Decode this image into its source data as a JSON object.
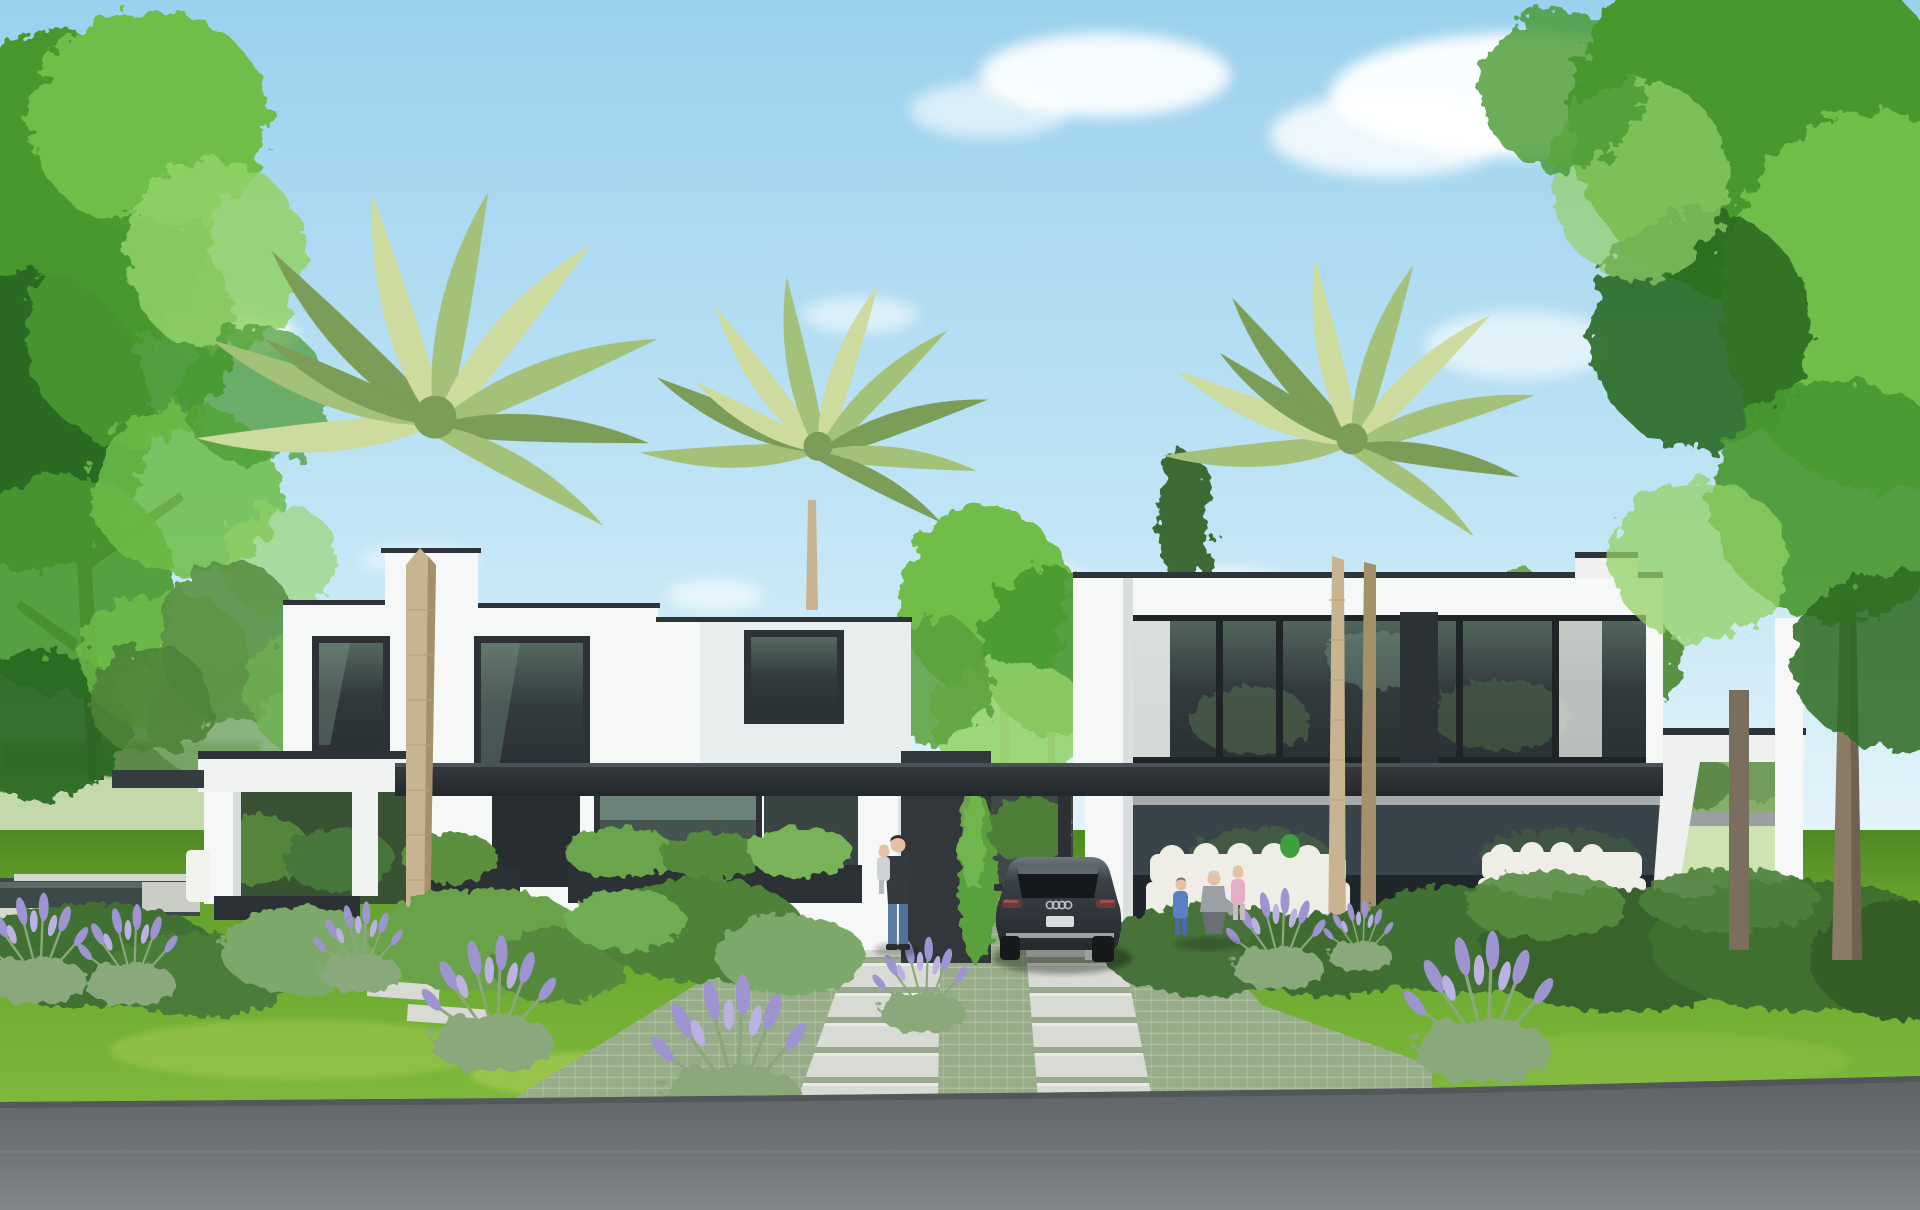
{
  "scene": {
    "type": "architectural-exterior-rendering",
    "description": "Daytime photorealistic render of two modern white flat-roof villas with dark window bands, connected by a dark carport canopy. Front garden with boxwood hedges, sage bushes and lavender, three palm trees, large deciduous trees at both edges, reflecting pond at left, green-paver driveway with light slab walkways, dark SUV parked under the canopy, a man carrying a child on the walkway, two children with an adult by the right hedge, white outdoor lounge furniture on both terraces, asphalt road in the foreground",
    "time_of_day": "day",
    "weather": "sunny, scattered soft clouds"
  },
  "objects": {
    "houses": 2,
    "palm_trees": 3,
    "deciduous_tree_groups": 2,
    "car": {
      "type": "suv",
      "badge": "audi-rings",
      "view": "rear",
      "color_name": "dark-gray"
    },
    "people": [
      {
        "who": "man-carrying-child",
        "clothing": "dark jacket, blue jeans"
      },
      {
        "who": "toddler",
        "clothing": "blue overalls"
      },
      {
        "who": "crouching-adult",
        "clothing": "gray"
      },
      {
        "who": "child",
        "clothing": "pink"
      }
    ],
    "pond": 1,
    "lavender_clusters": 9,
    "outdoor_sofa_groups": 3
  },
  "palette": {
    "sky-top": "#9bd1ee",
    "sky-mid": "#bfe4f5",
    "sky-horizon": "#e9f5fa",
    "cloud": "#ffffff",
    "tree-dark": "#2a6a22",
    "tree-mid": "#49982f",
    "tree-light": "#6fbd49",
    "tree-lighter": "#92d266",
    "palm-light": "#cddc9e",
    "palm-mid": "#a3c178",
    "palm-dark": "#7c9d57",
    "palm-trunk": "#c8b491",
    "palm-trunk-shadow": "#a5906c",
    "house-white": "#f5f8f7",
    "house-shade": "#e3e8e9",
    "coping": "#2e3438",
    "fascia": "#353c40",
    "fascia-dark": "#23282b",
    "glass": "#323a3e",
    "glass-frame": "#2c3236",
    "glass-reflect": "#8aa79b",
    "curtain": "#e9ece9",
    "door": "#282e32",
    "meadow": "#c3d9ab",
    "distant-hedge": "#5d8a49",
    "lawn": "#74b135",
    "lawn-dark": "#4e8822",
    "lawn-light": "#a6cb52",
    "hedge": "#3f7031",
    "hedge-light": "#69a24a",
    "bush-sage": "#7ba86a",
    "lavender": "#9d94d0",
    "lavender-light": "#bcb2e2",
    "lavender-leaf": "#8aa87c",
    "paver": "#9db191",
    "paver-line": "#c3cfb7",
    "slab": "#d8dbd3",
    "slab-gap": "#97a88c",
    "road": "#5d6265",
    "road-light": "#83878a",
    "pond": "#3c4a47",
    "pond-rim": "#d6d9d2",
    "car-body": "#3a4147",
    "car-body-dark": "#24292d",
    "car-glass": "#15191c",
    "car-chrome": "#b9bfc2",
    "car-tail": "#6b3a3c",
    "skin": "#e6c1a3",
    "denim": "#5d7ea3",
    "jacket": "#36393e",
    "gray-outfit": "#9aa0a4",
    "pink-outfit": "#e3aec6",
    "blue-outfit": "#5b7fc4",
    "white-furniture": "#efeee6"
  }
}
